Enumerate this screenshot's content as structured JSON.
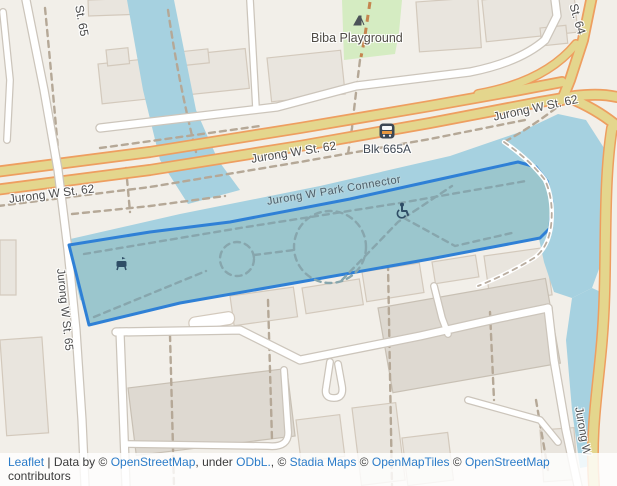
{
  "map": {
    "street_labels": {
      "st65_top": "St. 65",
      "st62_left": "Jurong W St. 62",
      "st62_mid": "Jurong W St. 62",
      "st62_right": "Jurong W St. 62",
      "st64": "St. 64",
      "st65_side": "Jurong W St. 65",
      "jurong_w_side": "Jurong W",
      "park_connector": "Jurong W Park Connector"
    },
    "poi_labels": {
      "playground": "Biba Playground",
      "bus_stop": "Blk 665A"
    },
    "icons": {
      "playground": "playground-icon",
      "bus_stop": "bus-stop-icon",
      "picnic": "picnic-site-icon",
      "wheelchair": "wheelchair-accessible-icon"
    },
    "colors": {
      "land": "#f2efe9",
      "water": "#a6d1e0",
      "road_major_fill": "#e4d68d",
      "road_major_casing": "#ee9e60",
      "road_minor_fill": "#ffffff",
      "road_minor_casing": "#ccc5bb",
      "park_green": "#d5ecc2",
      "building_fill": "#e9e5de",
      "building_stroke": "#d3c9bc",
      "path_dash": "#b5a897",
      "selection_fill": "#9bc6cd",
      "selection_stroke": "#2f80d6",
      "link_blue": "#2b7cc9"
    }
  },
  "attribution": {
    "parts": [
      {
        "t": "Leaflet"
      },
      {
        "t": " | Data by © "
      },
      {
        "t": "OpenStreetMap"
      },
      {
        "t": ", under "
      },
      {
        "t": "ODbL."
      },
      {
        "t": ", © "
      },
      {
        "t": "Stadia Maps"
      },
      {
        "t": " © "
      },
      {
        "t": "OpenMapTiles"
      },
      {
        "t": " © "
      },
      {
        "t": "OpenStreetMap"
      },
      {
        "t": " contributors"
      }
    ]
  }
}
